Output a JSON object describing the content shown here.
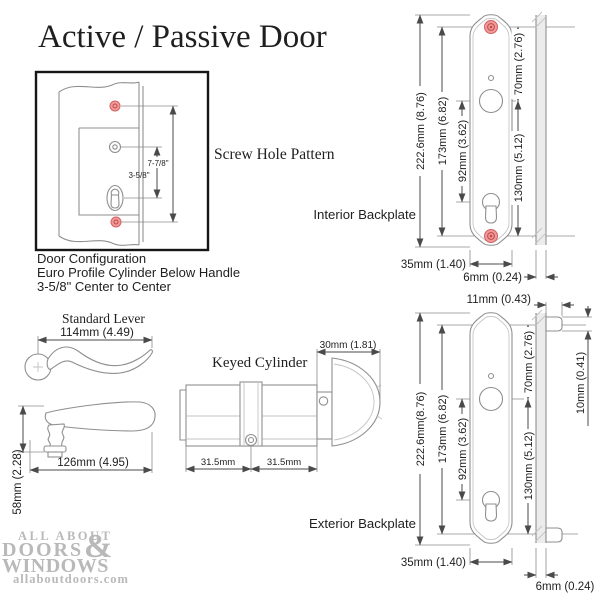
{
  "title": "Active / Passive Door",
  "screw_hole_pattern": {
    "label": "Screw Hole Pattern",
    "dim_screw_to_screw": "7-7/8\"",
    "dim_handle_to_cylinder": "3-5/8\""
  },
  "door_configuration": {
    "line1": "Door Configuration",
    "line2": "Euro Profile Cylinder Below Handle",
    "line3": "3-5/8\" Center to Center"
  },
  "standard_lever": {
    "label": "Standard Lever",
    "dim_top_length": "114mm (4.49)",
    "dim_side_length": "126mm (4.95)",
    "dim_side_height": "58mm (2.28)"
  },
  "keyed_cylinder": {
    "label": "Keyed Cylinder",
    "dim_thumbturn_width": "30mm (1.81)",
    "dim_left_half": "31.5mm",
    "dim_right_half": "31.5mm"
  },
  "interior_backplate": {
    "label": "Interior Backplate",
    "dim_total_height": "222.6mm (8.76)",
    "dim_screw_to_screw": "173mm (6.82)",
    "dim_handle_to_cylinder": "92mm (3.62)",
    "dim_top_screw_to_handle": "70mm (2.76)",
    "dim_handle_to_bottom_screw": "130mm (5.12)",
    "dim_width": "35mm (1.40)",
    "dim_thickness": "6mm (0.24)"
  },
  "exterior_backplate": {
    "label": "Exterior Backplate",
    "dim_total_height": "222.6mm(8.76)",
    "dim_screw_to_screw": "173mm (6.82)",
    "dim_handle_to_cylinder": "92mm (3.62)",
    "dim_top_screw_to_handle": "70mm (2.76)",
    "dim_handle_to_bottom_screw": "130mm (5.12)",
    "dim_width": "35mm (1.40)",
    "dim_thickness": "6mm (0.24)",
    "dim_tab_depth": "11mm (0.43)",
    "dim_tab_height": "10mm (0.41)"
  },
  "logo": {
    "line1": "ALL ABOUT",
    "ampersand": "&",
    "line2": "DOORS",
    "line3": "WINDOWS",
    "website": "allaboutdoors.com"
  },
  "colors": {
    "screw_highlight": "#f09a9a",
    "screw_ring": "#c04a4a",
    "drawing_gray": "#8f8f8f",
    "dimension_gray": "#4a4a4a",
    "logo_gray": "#b9b9b9"
  }
}
